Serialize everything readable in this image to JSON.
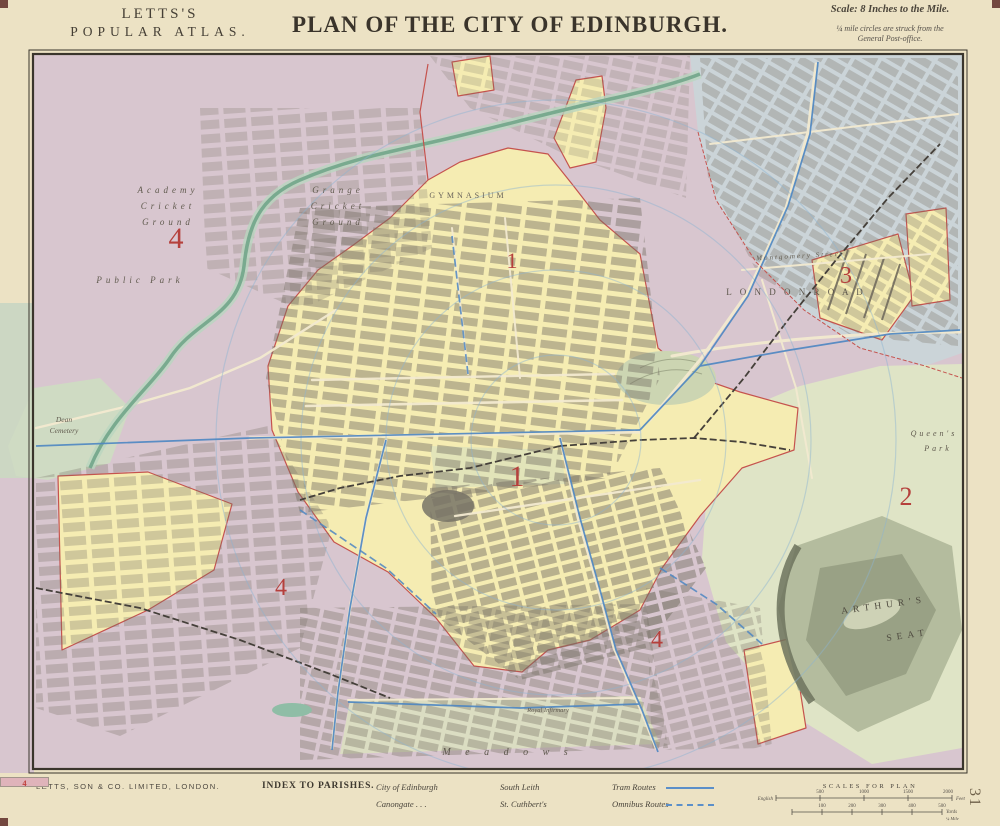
{
  "header": {
    "atlas_line1": "LETTS'S",
    "atlas_line2": "POPULAR ATLAS.",
    "title": "PLAN OF THE CITY OF EDINBURGH.",
    "scale_note": "Scale: 8 Inches to the Mile.",
    "circles_note_1": "¼ mile circles are struck from the",
    "circles_note_2": "General Post-office."
  },
  "map": {
    "colors": {
      "paper": "#ece2c4",
      "st_cuthberts": "#d8c6cf",
      "city": "#f5ecb2",
      "canongate": "#dfe4c6",
      "south_leith": "#cbd4d8",
      "tram": "#4d86c2",
      "boundary_red": "#c5534e",
      "water": "#79aa8f",
      "numeral_red": "#b5403c"
    },
    "labels": {
      "academy": [
        "Academy",
        "Cricket",
        "Ground"
      ],
      "grange": [
        "Grange",
        "Cricket",
        "Ground"
      ],
      "public_park": "Public Park",
      "gymnasium": "GYMNASIUM",
      "dean_cemetery": [
        "Dean",
        "Cemetery"
      ],
      "montgomery": "Montgomery Street",
      "london_road": "L O N D O N   R O A D",
      "queens_park": [
        "Queen's",
        "Park"
      ],
      "arthurs_seat": [
        "ARTHUR'S",
        "SEAT"
      ],
      "royal_infirmary": "Royal Infirmary",
      "meadows": "M e a d o w s"
    },
    "numerals": {
      "nw": "4",
      "north": "1",
      "ne": "3",
      "center": "1",
      "east": "2",
      "sw": "4",
      "south": "4"
    }
  },
  "footer": {
    "publisher": "LETTS, SON & CO. LIMITED, LONDON.",
    "index_title": "INDEX TO PARISHES.",
    "parishes": [
      {
        "name": "City of Edinburgh",
        "num": "1",
        "swatch_style": "background:#f1e7a8;width:49px;height:10px;border:1px solid #a2958b;text-align:center;line-height:10px;font-size:8.5px;color:#c0403c;font-weight:bold;box-sizing:border-box"
      },
      {
        "name": "Canongate . . .",
        "num": "2",
        "swatch_style": "background:#d9e0b2;width:49px;height:10px;border:1px solid #a2958b;text-align:center;line-height:10px;font-size:8.5px;color:#c0403c;font-weight:bold;box-sizing:border-box"
      },
      {
        "name": "South Leith",
        "num": "3",
        "swatch_style": "background:#ccd7d3;width:49px;height:10px;border:1px solid #a2958b;text-align:center;line-height:10px;font-size:8.5px;color:#c0403c;font-weight:bold;box-sizing:border-box"
      },
      {
        "name": "St. Cuthbert's",
        "num": "4",
        "swatch_style": "background:#dfb3ba;width:49px;height:10px;border:1px solid #a2958b;text-align:center;line-height:10px;font-size:8.5px;color:#c0403c;font-weight:bold;box-sizing:border-box"
      }
    ],
    "routes": [
      {
        "label": "Tram Routes",
        "line_style": "border-top:2px solid #5b8fc9;width:48px;height:0"
      },
      {
        "label": "Omnibus Routes",
        "line_style": "border-top:2px dashed #5b8fc9;width:48px;height:0"
      }
    ],
    "scales": {
      "title": "SCALES FOR PLAN",
      "feet": {
        "left": "English",
        "ticks": [
          "500",
          "1000",
          "1500",
          "2000"
        ],
        "unit": "Feet"
      },
      "yards": {
        "ticks": [
          "100",
          "200",
          "300",
          "400",
          "500"
        ],
        "unit": "Yards",
        "extra": "¼ Mile"
      }
    },
    "plate_number": "31"
  }
}
